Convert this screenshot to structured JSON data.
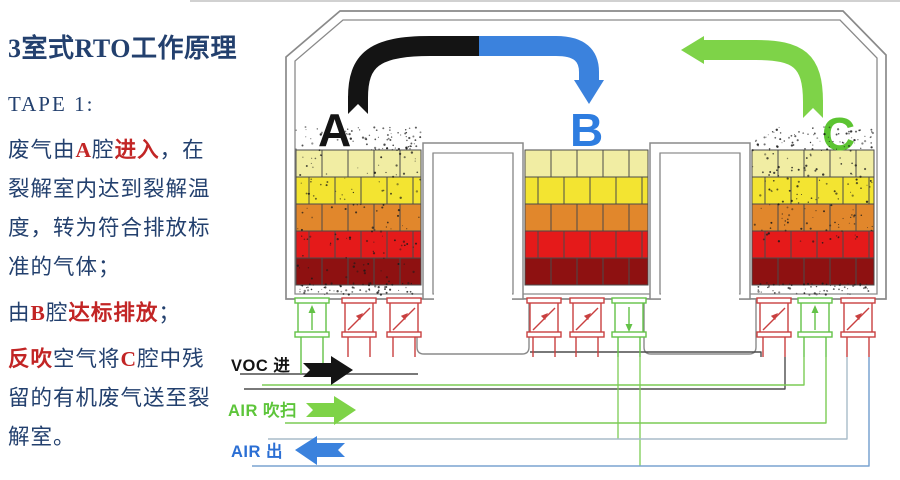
{
  "panel": {
    "title": "3室式RTO工作原理",
    "step_label": "TAPE 1:",
    "text_color": "#23406e",
    "highlight_color": "#c22525",
    "lines": [
      {
        "gap": false,
        "segments": [
          {
            "t": "废气由"
          },
          {
            "t": "A",
            "red": true
          },
          {
            "t": "腔"
          },
          {
            "t": "进入",
            "red": true
          },
          {
            "t": "，在"
          }
        ]
      },
      {
        "gap": false,
        "segments": [
          {
            "t": "裂解室内达到裂解温"
          }
        ]
      },
      {
        "gap": false,
        "segments": [
          {
            "t": "度，转为符合排放标"
          }
        ]
      },
      {
        "gap": false,
        "segments": [
          {
            "t": "准的气体；"
          }
        ]
      },
      {
        "gap": true,
        "segments": [
          {
            "t": "由"
          },
          {
            "t": "B",
            "red": true
          },
          {
            "t": "腔"
          },
          {
            "t": "达标排放",
            "red": true
          },
          {
            "t": "；"
          }
        ]
      },
      {
        "gap": true,
        "segments": [
          {
            "t": "反吹",
            "red": true
          },
          {
            "t": "空气将"
          },
          {
            "t": "C",
            "red": true
          },
          {
            "t": "腔中残"
          }
        ]
      },
      {
        "gap": false,
        "segments": [
          {
            "t": "留的有机废气送至裂"
          }
        ]
      },
      {
        "gap": false,
        "segments": [
          {
            "t": "解室。"
          }
        ]
      }
    ]
  },
  "diagram": {
    "chamber_labels": [
      {
        "text": "A",
        "color": "#141414"
      },
      {
        "text": "B",
        "color": "#2e7de0"
      },
      {
        "text": "C",
        "color": "#5cc432"
      }
    ],
    "flow_labels": [
      {
        "text": "VOC 进",
        "color": "#141414"
      },
      {
        "text": "AIR 吹扫",
        "color": "#5dc53a"
      },
      {
        "text": "AIR 出",
        "color": "#2b6fd4"
      }
    ],
    "arrow_colors": {
      "voc_in": "#141414",
      "clean_out": "#3b82dd",
      "purge": "#7ed348"
    },
    "brick_colors": [
      "#f1eda3",
      "#f3e431",
      "#e1872c",
      "#e51a1a",
      "#8e1111"
    ],
    "brick_area": {
      "top": 150,
      "bottom": 285,
      "rows": 5
    },
    "chambers": [
      {
        "name": "A",
        "x0": 296,
        "x1": 421,
        "dusty": true
      },
      {
        "name": "B",
        "x0": 525,
        "x1": 648,
        "dusty": false
      },
      {
        "name": "C",
        "x0": 752,
        "x1": 874,
        "dusty": true
      }
    ],
    "valve_colors": {
      "open": "#63c247",
      "closed": "#c94040"
    },
    "valves": [
      {
        "cx": 312,
        "state": "open",
        "dir": "up",
        "leg_to": 374
      },
      {
        "cx": 359,
        "state": "closed",
        "leg_to": 357
      },
      {
        "cx": 404,
        "state": "closed",
        "leg_to": 357
      },
      {
        "cx": 544,
        "state": "closed",
        "leg_to": 357
      },
      {
        "cx": 587,
        "state": "closed",
        "leg_to": 357
      },
      {
        "cx": 629,
        "state": "open",
        "dir": "down",
        "leg_to": 357
      },
      {
        "cx": 774,
        "state": "closed",
        "leg_to": 357
      },
      {
        "cx": 815,
        "state": "open",
        "dir": "up",
        "leg_to": 357
      },
      {
        "cx": 858,
        "state": "closed",
        "leg_to": 357
      }
    ]
  }
}
